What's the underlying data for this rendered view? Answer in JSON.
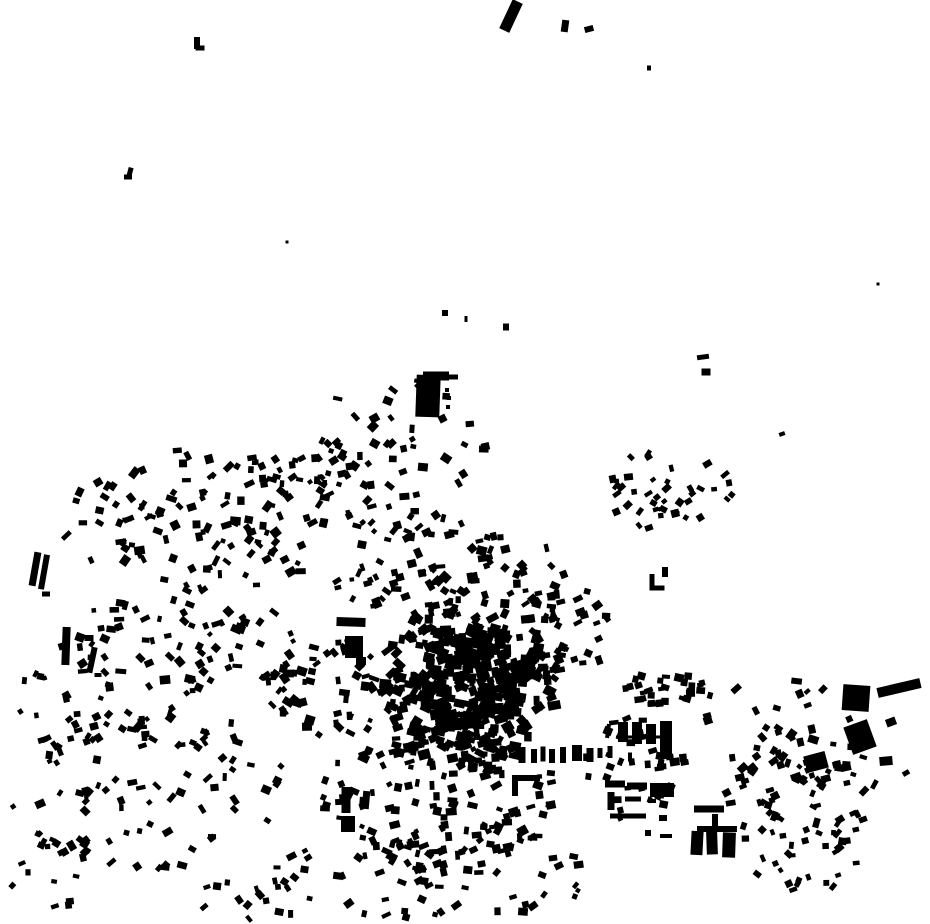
{
  "map": {
    "width": 930,
    "height": 924,
    "background": "#ffffff",
    "building_color": "#000000",
    "description": "figure-ground building footprint map, black buildings on white"
  },
  "landmarks": [
    [
      511,
      16,
      11,
      32,
      25
    ],
    [
      565,
      26,
      7,
      12,
      8
    ],
    [
      589,
      29,
      9,
      6,
      -15
    ],
    [
      649,
      68,
      4,
      5,
      0
    ],
    [
      197,
      43,
      6,
      12,
      0
    ],
    [
      200,
      48,
      9,
      5,
      0
    ],
    [
      130,
      172,
      5,
      9,
      15
    ],
    [
      128,
      177,
      8,
      5,
      0
    ],
    [
      287,
      242,
      3,
      3,
      0
    ],
    [
      878,
      284,
      3,
      3,
      0
    ],
    [
      445,
      313,
      6,
      6,
      0
    ],
    [
      466,
      319,
      3,
      6,
      0
    ],
    [
      506,
      327,
      6,
      7,
      0
    ],
    [
      703,
      357,
      12,
      5,
      -8
    ],
    [
      706,
      372,
      9,
      7,
      0
    ],
    [
      782,
      434,
      6,
      4,
      -20
    ],
    [
      428,
      396,
      24,
      42,
      2
    ],
    [
      436,
      376,
      26,
      9,
      0
    ],
    [
      452,
      377,
      12,
      5,
      0
    ],
    [
      447,
      390,
      4,
      4,
      0
    ],
    [
      449,
      398,
      4,
      4,
      0
    ],
    [
      448,
      407,
      4,
      4,
      0
    ],
    [
      35,
      569,
      7,
      34,
      10
    ],
    [
      44,
      572,
      6,
      35,
      10
    ],
    [
      46,
      594,
      8,
      5,
      0
    ],
    [
      66,
      646,
      8,
      38,
      2
    ],
    [
      89,
      638,
      9,
      6,
      0
    ],
    [
      92,
      660,
      6,
      26,
      12
    ],
    [
      98,
      675,
      7,
      4,
      0
    ],
    [
      351,
      622,
      29,
      9,
      2
    ],
    [
      354,
      647,
      18,
      22,
      0
    ],
    [
      361,
      661,
      10,
      8,
      0
    ],
    [
      652,
      581,
      5,
      14,
      0
    ],
    [
      657,
      588,
      15,
      5,
      0
    ],
    [
      665,
      572,
      6,
      10,
      0
    ],
    [
      856,
      698,
      27,
      26,
      4
    ],
    [
      860,
      737,
      25,
      29,
      -20
    ],
    [
      899,
      688,
      44,
      10,
      -13
    ],
    [
      816,
      762,
      22,
      17,
      -15
    ],
    [
      886,
      761,
      13,
      9,
      -5
    ],
    [
      906,
      773,
      7,
      5,
      -30
    ],
    [
      891,
      722,
      10,
      8,
      -20
    ],
    [
      709,
      809,
      30,
      7,
      0
    ],
    [
      715,
      821,
      6,
      14,
      0
    ],
    [
      717,
      829,
      40,
      6,
      0
    ],
    [
      697,
      843,
      12,
      24,
      3
    ],
    [
      712,
      843,
      11,
      23,
      -2
    ],
    [
      729,
      845,
      13,
      25,
      2
    ],
    [
      608,
      731,
      4,
      14,
      8
    ],
    [
      623,
      732,
      10,
      20,
      0
    ],
    [
      637,
      733,
      10,
      22,
      0
    ],
    [
      651,
      734,
      10,
      20,
      0
    ],
    [
      666,
      740,
      12,
      38,
      0
    ],
    [
      641,
      737,
      50,
      3,
      0
    ],
    [
      610,
      752,
      5,
      12,
      0
    ],
    [
      630,
      757,
      4,
      9,
      0
    ],
    [
      661,
      766,
      8,
      4,
      0
    ],
    [
      615,
      784,
      20,
      7,
      0
    ],
    [
      637,
      786,
      20,
      7,
      0
    ],
    [
      662,
      790,
      24,
      14,
      0
    ],
    [
      611,
      801,
      7,
      18,
      0
    ],
    [
      633,
      799,
      16,
      5,
      0
    ],
    [
      652,
      801,
      8,
      4,
      0
    ],
    [
      628,
      816,
      36,
      5,
      0
    ],
    [
      663,
      818,
      8,
      6,
      0
    ],
    [
      648,
      833,
      6,
      6,
      0
    ],
    [
      666,
      836,
      12,
      4,
      0
    ],
    [
      346,
      800,
      9,
      26,
      0
    ],
    [
      348,
      824,
      14,
      16,
      0
    ],
    [
      366,
      800,
      7,
      18,
      5
    ],
    [
      526,
      778,
      28,
      6,
      0
    ],
    [
      515,
      787,
      6,
      18,
      0
    ],
    [
      522,
      755,
      7,
      16,
      0
    ],
    [
      534,
      756,
      6,
      14,
      0
    ],
    [
      543,
      754,
      5,
      15,
      0
    ],
    [
      552,
      756,
      6,
      14,
      0
    ],
    [
      563,
      755,
      6,
      16,
      0
    ],
    [
      577,
      753,
      10,
      16,
      0
    ],
    [
      590,
      755,
      7,
      14,
      0
    ],
    [
      600,
      753,
      5,
      10,
      0
    ]
  ],
  "clusters": [
    {
      "name": "nw-field",
      "cx": 205,
      "cy": 520,
      "rx": 150,
      "ry": 72,
      "inner": 0,
      "count": 120,
      "wmin": 4,
      "wmax": 11,
      "hmin": 4,
      "hmax": 9,
      "angle": -20,
      "jitter": 45,
      "seed": 11
    },
    {
      "name": "nw-top-line",
      "cx": 300,
      "cy": 470,
      "rx": 55,
      "ry": 14,
      "inner": 0,
      "count": 22,
      "wmin": 4,
      "wmax": 9,
      "hmin": 4,
      "hmax": 8,
      "angle": -10,
      "jitter": 30,
      "seed": 198
    },
    {
      "name": "west-mid",
      "cx": 185,
      "cy": 645,
      "rx": 115,
      "ry": 58,
      "inner": 0,
      "count": 75,
      "wmin": 4,
      "wmax": 11,
      "hmin": 4,
      "hmax": 9,
      "angle": 10,
      "jitter": 45,
      "seed": 22
    },
    {
      "name": "sw-scatter",
      "cx": 150,
      "cy": 790,
      "rx": 140,
      "ry": 85,
      "inner": 0,
      "count": 95,
      "wmin": 4,
      "wmax": 10,
      "hmin": 4,
      "hmax": 8,
      "angle": 0,
      "jitter": 60,
      "seed": 33
    },
    {
      "name": "far-left-mid",
      "cx": 60,
      "cy": 700,
      "rx": 45,
      "ry": 60,
      "inner": 0,
      "count": 22,
      "wmin": 4,
      "wmax": 9,
      "hmin": 4,
      "hmax": 8,
      "angle": 10,
      "jitter": 45,
      "seed": 220
    },
    {
      "name": "bottom-left-sparse",
      "cx": 50,
      "cy": 865,
      "rx": 45,
      "ry": 45,
      "inner": 0,
      "count": 16,
      "wmin": 4,
      "wmax": 9,
      "hmin": 4,
      "hmax": 8,
      "angle": 0,
      "jitter": 45,
      "seed": 231
    },
    {
      "name": "bottom-edge-left",
      "cx": 250,
      "cy": 898,
      "rx": 60,
      "ry": 22,
      "inner": 0,
      "count": 14,
      "wmin": 4,
      "wmax": 9,
      "hmin": 4,
      "hmax": 8,
      "angle": 20,
      "jitter": 40,
      "seed": 242
    },
    {
      "name": "north-scatter",
      "cx": 400,
      "cy": 455,
      "rx": 88,
      "ry": 82,
      "inner": 0,
      "count": 65,
      "wmin": 4,
      "wmax": 10,
      "hmin": 4,
      "hmax": 9,
      "angle": 0,
      "jitter": 50,
      "seed": 44
    },
    {
      "name": "mid-band",
      "cx": 450,
      "cy": 573,
      "rx": 118,
      "ry": 50,
      "inner": 0,
      "count": 85,
      "wmin": 4,
      "wmax": 11,
      "hmin": 4,
      "hmax": 9,
      "angle": 30,
      "jitter": 50,
      "seed": 55
    },
    {
      "name": "ne-scatter",
      "cx": 663,
      "cy": 488,
      "rx": 72,
      "ry": 42,
      "inner": 0,
      "count": 42,
      "wmin": 4,
      "wmax": 9,
      "hmin": 4,
      "hmax": 8,
      "angle": -35,
      "jitter": 30,
      "seed": 66
    },
    {
      "name": "core-block-1",
      "cx": 444,
      "cy": 650,
      "rx": 26,
      "ry": 20,
      "inner": 0,
      "count": 50,
      "wmin": 5,
      "wmax": 13,
      "hmin": 5,
      "hmax": 11,
      "angle": 0,
      "jitter": 25,
      "seed": 71
    },
    {
      "name": "core-block-2",
      "cx": 487,
      "cy": 641,
      "rx": 24,
      "ry": 17,
      "inner": 0,
      "count": 45,
      "wmin": 5,
      "wmax": 13,
      "hmin": 5,
      "hmax": 11,
      "angle": 10,
      "jitter": 25,
      "seed": 72
    },
    {
      "name": "core-block-3",
      "cx": 514,
      "cy": 668,
      "rx": 20,
      "ry": 18,
      "inner": 0,
      "count": 40,
      "wmin": 5,
      "wmax": 13,
      "hmin": 5,
      "hmax": 11,
      "angle": -15,
      "jitter": 25,
      "seed": 73
    },
    {
      "name": "core-block-4",
      "cx": 498,
      "cy": 703,
      "rx": 24,
      "ry": 17,
      "inner": 0,
      "count": 45,
      "wmin": 5,
      "wmax": 13,
      "hmin": 5,
      "hmax": 11,
      "angle": 5,
      "jitter": 25,
      "seed": 74
    },
    {
      "name": "core-block-5",
      "cx": 458,
      "cy": 713,
      "rx": 24,
      "ry": 16,
      "inner": 0,
      "count": 42,
      "wmin": 5,
      "wmax": 13,
      "hmin": 5,
      "hmax": 11,
      "angle": 0,
      "jitter": 25,
      "seed": 75
    },
    {
      "name": "core-block-6",
      "cx": 428,
      "cy": 688,
      "rx": 20,
      "ry": 20,
      "inner": 0,
      "count": 42,
      "wmin": 5,
      "wmax": 13,
      "hmin": 5,
      "hmax": 11,
      "angle": 15,
      "jitter": 25,
      "seed": 76
    },
    {
      "name": "core-block-7",
      "cx": 470,
      "cy": 674,
      "rx": 22,
      "ry": 18,
      "inner": 0,
      "count": 40,
      "wmin": 5,
      "wmax": 12,
      "hmin": 5,
      "hmax": 10,
      "angle": 0,
      "jitter": 25,
      "seed": 77
    },
    {
      "name": "core-ring",
      "cx": 470,
      "cy": 678,
      "rx": 92,
      "ry": 82,
      "inner": 0.72,
      "count": 85,
      "wmin": 5,
      "wmax": 13,
      "hmin": 5,
      "hmax": 10,
      "angle": 0,
      "jitter": 45,
      "seed": 88
    },
    {
      "name": "core-south-band",
      "cx": 468,
      "cy": 745,
      "rx": 78,
      "ry": 26,
      "inner": 0,
      "count": 60,
      "wmin": 5,
      "wmax": 12,
      "hmin": 5,
      "hmax": 10,
      "angle": 0,
      "jitter": 30,
      "seed": 121
    },
    {
      "name": "west-approach",
      "cx": 330,
      "cy": 692,
      "rx": 62,
      "ry": 55,
      "inner": 0,
      "count": 55,
      "wmin": 4,
      "wmax": 11,
      "hmin": 4,
      "hmax": 9,
      "angle": 20,
      "jitter": 40,
      "seed": 132
    },
    {
      "name": "east-of-core",
      "cx": 562,
      "cy": 628,
      "rx": 46,
      "ry": 56,
      "inner": 0,
      "count": 48,
      "wmin": 4,
      "wmax": 10,
      "hmin": 4,
      "hmax": 9,
      "angle": 0,
      "jitter": 40,
      "seed": 143
    },
    {
      "name": "south-field",
      "cx": 440,
      "cy": 800,
      "rx": 120,
      "ry": 72,
      "inner": 0,
      "count": 130,
      "wmin": 4,
      "wmax": 11,
      "hmin": 4,
      "hmax": 9,
      "angle": 0,
      "jitter": 30,
      "seed": 99
    },
    {
      "name": "south-bottom",
      "cx": 430,
      "cy": 878,
      "rx": 175,
      "ry": 40,
      "inner": 0,
      "count": 65,
      "wmin": 4,
      "wmax": 10,
      "hmin": 4,
      "hmax": 8,
      "angle": 0,
      "jitter": 40,
      "seed": 110
    },
    {
      "name": "east-row",
      "cx": 664,
      "cy": 690,
      "rx": 56,
      "ry": 16,
      "inner": 0,
      "count": 30,
      "wmin": 5,
      "wmax": 10,
      "hmin": 4,
      "hmax": 8,
      "angle": 0,
      "jitter": 20,
      "seed": 154
    },
    {
      "name": "east-mid-fill",
      "cx": 640,
      "cy": 770,
      "rx": 55,
      "ry": 55,
      "inner": 0,
      "count": 35,
      "wmin": 4,
      "wmax": 10,
      "hmin": 4,
      "hmax": 8,
      "angle": 0,
      "jitter": 25,
      "seed": 209
    },
    {
      "name": "east-sparse",
      "cx": 788,
      "cy": 733,
      "rx": 92,
      "ry": 55,
      "inner": 0,
      "count": 38,
      "wmin": 5,
      "wmax": 11,
      "hmin": 4,
      "hmax": 9,
      "angle": -20,
      "jitter": 40,
      "seed": 165
    },
    {
      "name": "se-diag",
      "cx": 800,
      "cy": 793,
      "rx": 78,
      "ry": 48,
      "inner": 0,
      "count": 48,
      "wmin": 4,
      "wmax": 10,
      "hmin": 4,
      "hmax": 8,
      "angle": -40,
      "jitter": 35,
      "seed": 176
    },
    {
      "name": "se-bottom",
      "cx": 808,
      "cy": 852,
      "rx": 68,
      "ry": 42,
      "inner": 0,
      "count": 30,
      "wmin": 4,
      "wmax": 9,
      "hmin": 4,
      "hmax": 8,
      "angle": -30,
      "jitter": 40,
      "seed": 187
    }
  ]
}
